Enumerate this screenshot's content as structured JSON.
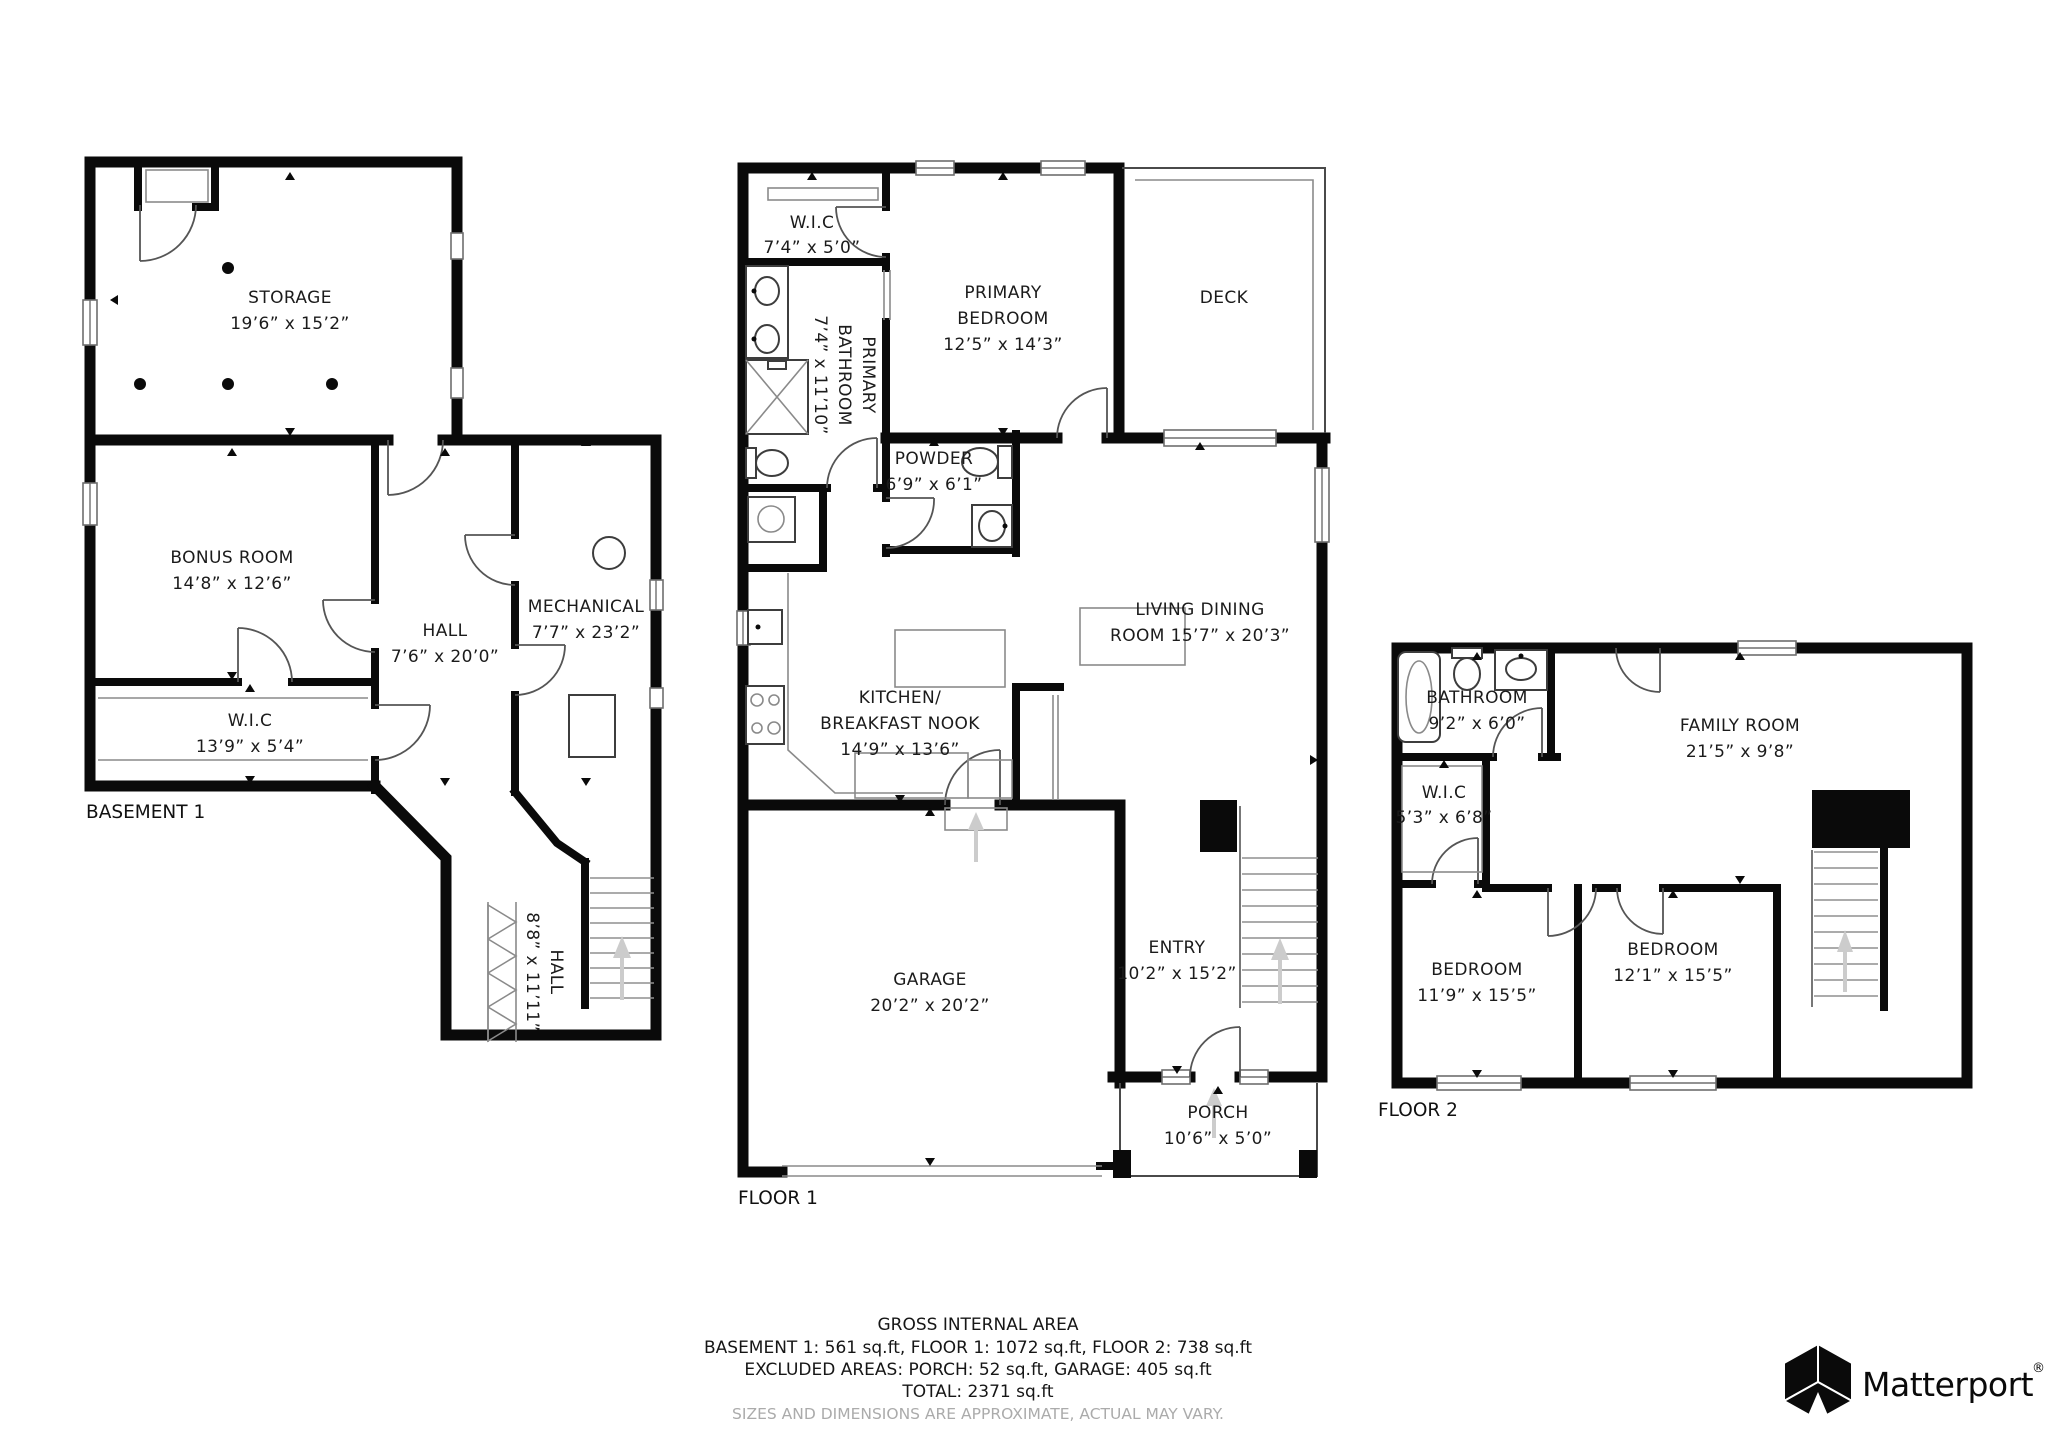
{
  "plans": {
    "basement": {
      "label": "BASEMENT 1",
      "rooms": {
        "storage": {
          "name": "STORAGE",
          "dims": "19’6” x 15’2”"
        },
        "bonus": {
          "name": "BONUS ROOM",
          "dims": "14’8” x 12’6”"
        },
        "hall": {
          "name": "HALL",
          "dims": "7’6” x 20’0”"
        },
        "mechanical": {
          "name": "MECHANICAL",
          "dims": "7’7” x 23’2”"
        },
        "wic": {
          "name": "W.I.C",
          "dims": "13’9” x 5’4”"
        },
        "hall2": {
          "name": "HALL",
          "dims": "8’8” x 11’11”"
        }
      }
    },
    "floor1": {
      "label": "FLOOR 1",
      "rooms": {
        "wic": {
          "name": "W.I.C",
          "dims": "7’4” x 5’0”"
        },
        "primary_bathroom": {
          "line1": "PRIMARY",
          "line2": "BATHROOM",
          "dims": "7’4” x 11’10”"
        },
        "primary_bedroom": {
          "line1": "PRIMARY",
          "line2": "BEDROOM",
          "dims": "12’5” x 14’3”"
        },
        "deck": {
          "name": "DECK"
        },
        "powder": {
          "name": "POWDER",
          "dims": "6’9” x 6’1”"
        },
        "kitchen": {
          "line1": "KITCHEN/",
          "line2": "BREAKFAST NOOK",
          "dims": "14’9” x 13’6”"
        },
        "living": {
          "line1": "LIVING DINING",
          "line2": "ROOM 15’7” x 20’3”"
        },
        "entry": {
          "name": "ENTRY",
          "dims": "10’2” x 15’2”"
        },
        "garage": {
          "name": "GARAGE",
          "dims": "20’2” x 20’2”"
        },
        "porch": {
          "name": "PORCH",
          "dims": "10’6” x 5’0”"
        }
      }
    },
    "floor2": {
      "label": "FLOOR 2",
      "rooms": {
        "bathroom": {
          "name": "BATHROOM",
          "dims": "9’2” x 6’0”"
        },
        "wic": {
          "name": "W.I.C",
          "dims": "5’3” x 6’8”"
        },
        "family": {
          "name": "FAMILY ROOM",
          "dims": "21’5” x 9’8”"
        },
        "bedroom1": {
          "name": "BEDROOM",
          "dims": "11’9” x 15’5”"
        },
        "bedroom2": {
          "name": "BEDROOM",
          "dims": "12’1” x 15’5”"
        }
      }
    }
  },
  "footer": {
    "title": "GROSS INTERNAL AREA",
    "line1": "BASEMENT 1: 561 sq.ft, FLOOR 1: 1072 sq.ft, FLOOR 2: 738 sq.ft",
    "line2": "EXCLUDED AREAS: PORCH: 52 sq.ft, GARAGE: 405 sq.ft",
    "line3": "TOTAL: 2371 sq.ft",
    "disclaimer": "SIZES AND DIMENSIONS ARE APPROXIMATE, ACTUAL MAY VARY."
  },
  "brand": {
    "name": "Matterport",
    "registered": "®"
  }
}
